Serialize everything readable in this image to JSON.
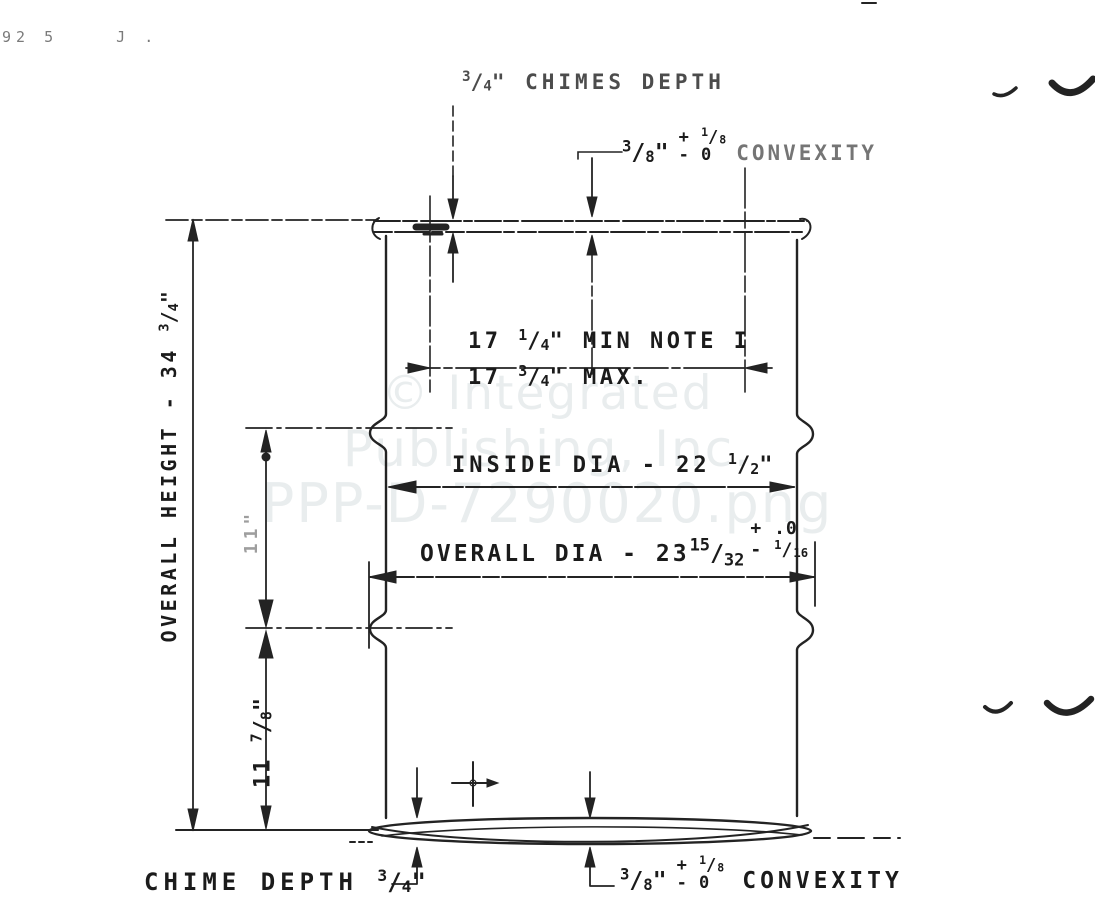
{
  "watermark": {
    "line1": "© Integrated",
    "line2": "Publishing, Inc.",
    "line3": "PPP-D-7290020.png"
  },
  "scribbles": {
    "left": "92 5",
    "right": "J ."
  },
  "dims": {
    "chimes_top": {
      "n": "3",
      "s": "/",
      "d": "4",
      "post": "\" CHIMES DEPTH"
    },
    "conv_top": {
      "n": "3",
      "s": "/",
      "d": "8",
      "q": "\"",
      "plus_sign": "+",
      "pn": "1",
      "ps": "/",
      "pd": "8",
      "minus": "- 0",
      "label": "CONVEXITY"
    },
    "d17min": {
      "pre": "17 ",
      "n": "1",
      "s": "/",
      "d": "4",
      "post": "\" MIN  NOTE I"
    },
    "d17max": {
      "pre": "17 ",
      "n": "3",
      "s": "/",
      "d": "4",
      "post": "\" MAX."
    },
    "inside_dia": {
      "pre": "INSIDE DIA - 22 ",
      "n": "1",
      "s": "/",
      "d": "2",
      "post": "\""
    },
    "overall_dia": {
      "pre": "OVERALL DIA - 23",
      "n": "15",
      "s": "/",
      "d": "32",
      "plus": "+ .0",
      "minus_sign": "- ",
      "mn": "1",
      "ms": "/",
      "md": "16"
    },
    "overall_height": {
      "pre": "OVERALL HEIGHT - 34 ",
      "n": "3",
      "s": "/",
      "d": "4",
      "post": "\""
    },
    "mid_height": {
      "text": "11\""
    },
    "lower_height": {
      "pre": "11 ",
      "n": "7",
      "s": "/",
      "d": "8",
      "post": "\""
    },
    "chime_bottom": {
      "pre": "CHIME DEPTH ",
      "n": "3",
      "s": "/",
      "d": "4",
      "post": "\""
    },
    "conv_bottom": {
      "n": "3",
      "s": "/",
      "d": "8",
      "q": "\"",
      "plus_sign": "+",
      "pn": "1",
      "ps": "/",
      "pd": "8",
      "minus": "- 0",
      "label": "CONVEXITY"
    }
  }
}
